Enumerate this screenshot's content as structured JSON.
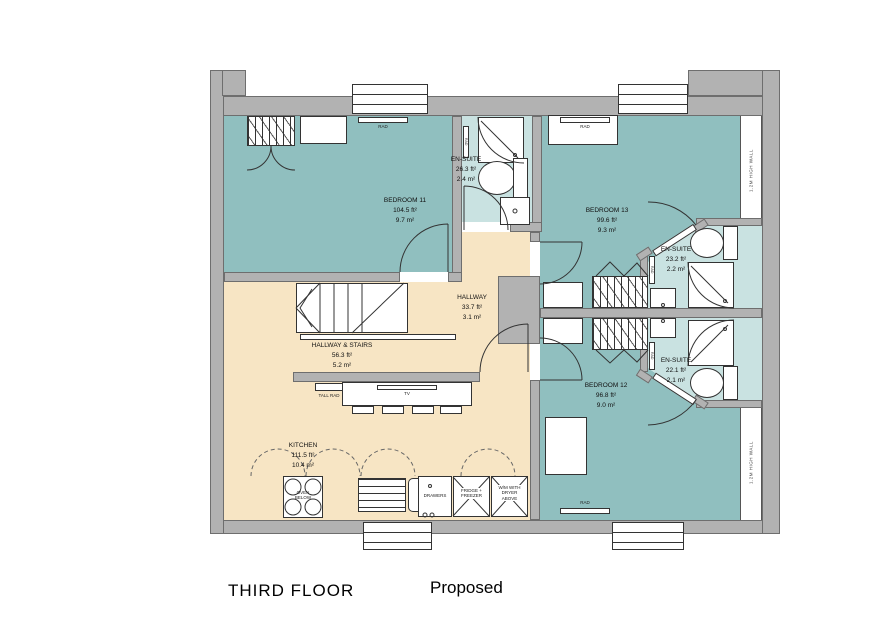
{
  "title": {
    "floor": "THIRD FLOOR",
    "status": "Proposed"
  },
  "colors": {
    "wall_gray": "#b2b2b2",
    "bedroom_teal": "#90bfbf",
    "ensuite_teal": "#c9e2e1",
    "hallway_cream": "#f7e5c4",
    "line": "#333333"
  },
  "rooms": {
    "bedroom11": {
      "name": "BEDROOM 11",
      "area_ft": "104.5 ft²",
      "area_m": "9.7 m²"
    },
    "ensuite_bedroom11": {
      "name": "EN-SUITE",
      "area_ft": "26.3 ft²",
      "area_m": "2.4 m²"
    },
    "bedroom13": {
      "name": "BEDROOM 13",
      "area_ft": "99.6 ft²",
      "area_m": "9.3 m²"
    },
    "ensuite_bedroom13": {
      "name": "EN-SUITE",
      "area_ft": "23.2 ft²",
      "area_m": "2.2 m²"
    },
    "ensuite_bedroom12": {
      "name": "EN-SUITE",
      "area_ft": "22.1 ft²",
      "area_m": "2.1 m²"
    },
    "bedroom12": {
      "name": "BEDROOM 12",
      "area_ft": "96.8 ft²",
      "area_m": "9.0 m²"
    },
    "hallway": {
      "name": "HALLWAY",
      "area_ft": "33.7 ft²",
      "area_m": "3.1 m²"
    },
    "hallway_stairs": {
      "name": "HALLWAY & STAIRS",
      "area_ft": "56.3 ft²",
      "area_m": "5.2 m²"
    },
    "kitchen": {
      "name": "KITCHEN",
      "area_ft": "111.5 ft²",
      "area_m": "10.4 m²"
    }
  },
  "annotations": {
    "rad": "RAD",
    "tall_rad": "TALL RAD",
    "tv": "TV",
    "drawers": "DRAWERS",
    "fridge_freezer": "FRIDGE +\nFREEZER",
    "wm_dryer": "W/M WITH\nDRYER\nABOVE",
    "oven": "OVEN\nBELOW",
    "high_wall": "1.2M HIGH WALL"
  }
}
